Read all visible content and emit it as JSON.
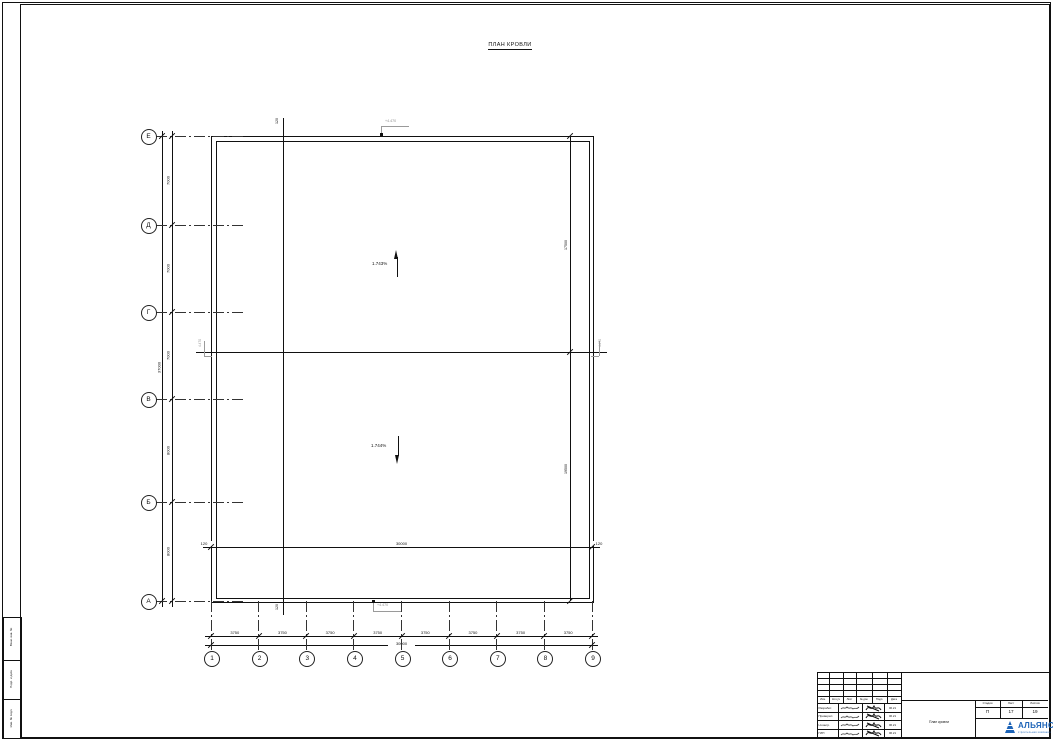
{
  "drawing": {
    "title": "ПЛАН КРОВЛИ"
  },
  "plan": {
    "slopes": [
      {
        "label": "1.743%",
        "dir": "up"
      },
      {
        "label": "1.744%",
        "dir": "down"
      }
    ],
    "row_axes": [
      "Е",
      "Д",
      "Г",
      "В",
      "Б",
      "А"
    ],
    "row_dims": [
      "7000",
      "7000",
      "7000",
      "8000",
      "8000"
    ],
    "row_total": "37000",
    "col_axes": [
      "1",
      "2",
      "3",
      "4",
      "5",
      "6",
      "7",
      "8",
      "9"
    ],
    "col_dims": [
      "3750",
      "3750",
      "3750",
      "3750",
      "3750",
      "3750",
      "3750",
      "3750"
    ],
    "col_total": "30000",
    "inner_dims": {
      "left": "120",
      "center": "30000",
      "right": "120"
    },
    "parapet_offsets": {
      "top": "120",
      "bottom": "120"
    },
    "right_dims": {
      "upper": "17500",
      "lower": "19500"
    },
    "elevations": {
      "top": "+4.470",
      "bottom": "+4.470",
      "left": "4.470",
      "right": "4.470"
    }
  },
  "side_stamp": {
    "cells": [
      "Взам. инв. №",
      "Подп. и дата",
      "Инв. № подл."
    ]
  },
  "title_block": {
    "header_cols": [
      "Изм.",
      "Кол.уч",
      "Лист",
      "№ док.",
      "Подп.",
      "Дата"
    ],
    "signature_rows": [
      {
        "role": "Разработ.",
        "date": "06.21"
      },
      {
        "role": "Проверил",
        "date": "06.21"
      },
      {
        "role": "Н.контр.",
        "date": "06.21"
      },
      {
        "role": "ГИП",
        "date": "06.21"
      }
    ],
    "doc_title": "План кровли",
    "stage": {
      "label": "Стадия",
      "value": "П"
    },
    "sheet": {
      "label": "Лист",
      "value": "17"
    },
    "sheets": {
      "label": "Листов",
      "value": "19"
    },
    "company": {
      "name": "АЛЬЯНС",
      "tagline": "строительная компания",
      "color": "#1c63b7"
    }
  }
}
